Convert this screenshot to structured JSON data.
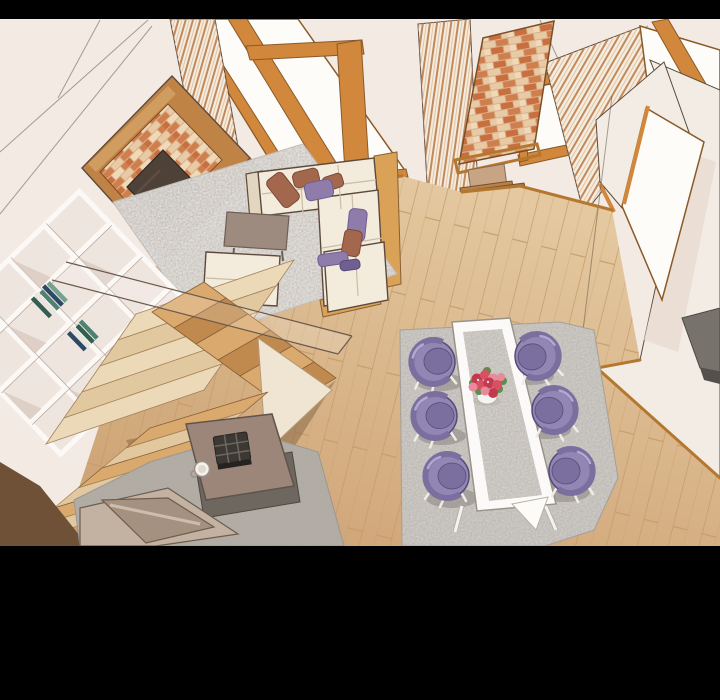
{
  "panel": {
    "description": "Webtoon-style illustration: high-angle view of a modern living and dining room. No text is visible in the image.",
    "visible_text": "none",
    "letterboxed": true
  },
  "letterbox": {
    "color": "#000000",
    "top_height_px": 19,
    "bottom_start_px": 546,
    "bottom_height_px": 154
  },
  "objects": [
    "black letterbox bars",
    "cream walls with panel lines",
    "tall window with orange wood frame",
    "wood slat panel",
    "striped curtains",
    "brick media wall with mounted TV",
    "brick pillar on stepped pedestal with floor mat",
    "small framed window",
    "bright doorway opening",
    "dark kitchen counter",
    "wood plank floor",
    "white shag rug",
    "L-shaped cream sectional sofa with purple and brown pillows",
    "square gray-brown coffee table",
    "cream ottoman",
    "white diamond-grid bookshelf with books",
    "glass stair railing",
    "L-shaped wooden staircase",
    "gray rug",
    "taupe side table with dark tray and white cup",
    "taupe lounge chair",
    "dining rug",
    "white dining table with marble top",
    "vase of red and pink roses",
    "six purple tub dining chairs"
  ],
  "palette": {
    "letterbox": "#000000",
    "outline": "#5d4a3c",
    "wall": "#f3eae4",
    "wall2": "#f2ece4",
    "wall_shade": "#e9dcd2",
    "trim": "#d1883c",
    "trim_dark": "#8a5a28",
    "trim2": "#b5772f",
    "window_white": "#fdfcf8",
    "curtain_base": "#f5ecdf",
    "curtain_stripe": "#c08a5c",
    "wood_frame": "#c08346",
    "brick_mortar": "#d9b08a",
    "brick1": "#cf7f4e",
    "brick2": "#e8cba6",
    "brick3": "#c96f3f",
    "brick4": "#f0d9b8",
    "tv": "#4e4238",
    "floor_light": "#e4c89f",
    "floor_dark": "#cda173",
    "plank_line": "#c49a67",
    "platform": "#d9a257",
    "rug_white": "#efecea",
    "rug_gray": "#b4aea6",
    "rug_dining": "#d6d2ce",
    "sofa": "#f3ebdb",
    "sofa_shadow": "#e3d6c0",
    "pillow_purple": "#8f7cab",
    "pillow_purple_dark": "#6f5f92",
    "pillow_brown": "#a2674d",
    "pillow_brown_dark": "#7c4a35",
    "table_gb": "#9d8b7f",
    "table_taupe": "#9c8679",
    "mat_dark": "#6e6760",
    "stair_cream": "#ecd9b8",
    "stair_cream2": "#e2c89f",
    "stair_tan": "#d9a96d",
    "stair_tan2": "#c08a4f",
    "stair_stringer": "#f0e5d2",
    "stair_dark": "#7b5a3a",
    "shelf_bg": "#efe5df",
    "shelf_line": "#fbf8f5",
    "shelf_shadow": "#d9c9c1",
    "book1": "#335e50",
    "book2": "#e9e6df",
    "book3": "#4e8171",
    "book4": "#2c4a66",
    "book5": "#74a08e",
    "chair_purple": "#9287b4",
    "chair_purple_mid": "#7b6fa0",
    "chair_purple_dark": "#564c78",
    "chair_highlight": "#b3a8cf",
    "shadow_gray": "#85807a",
    "table_white": "#fbfaf8",
    "marble": "#dbd7d2",
    "flower_red": "#c23a4c",
    "flower_red2": "#d94f63",
    "flower_pink": "#e88a9b",
    "leaf": "#5d8c4b",
    "vase": "#f6f4ef",
    "chaise_top": "#c3b2a2",
    "chaise_side": "#a5917f",
    "counter": "#77726c",
    "counter_dark": "#55504b",
    "dark_corner": "#6f5138",
    "glass_line": "#6b5b4c"
  }
}
